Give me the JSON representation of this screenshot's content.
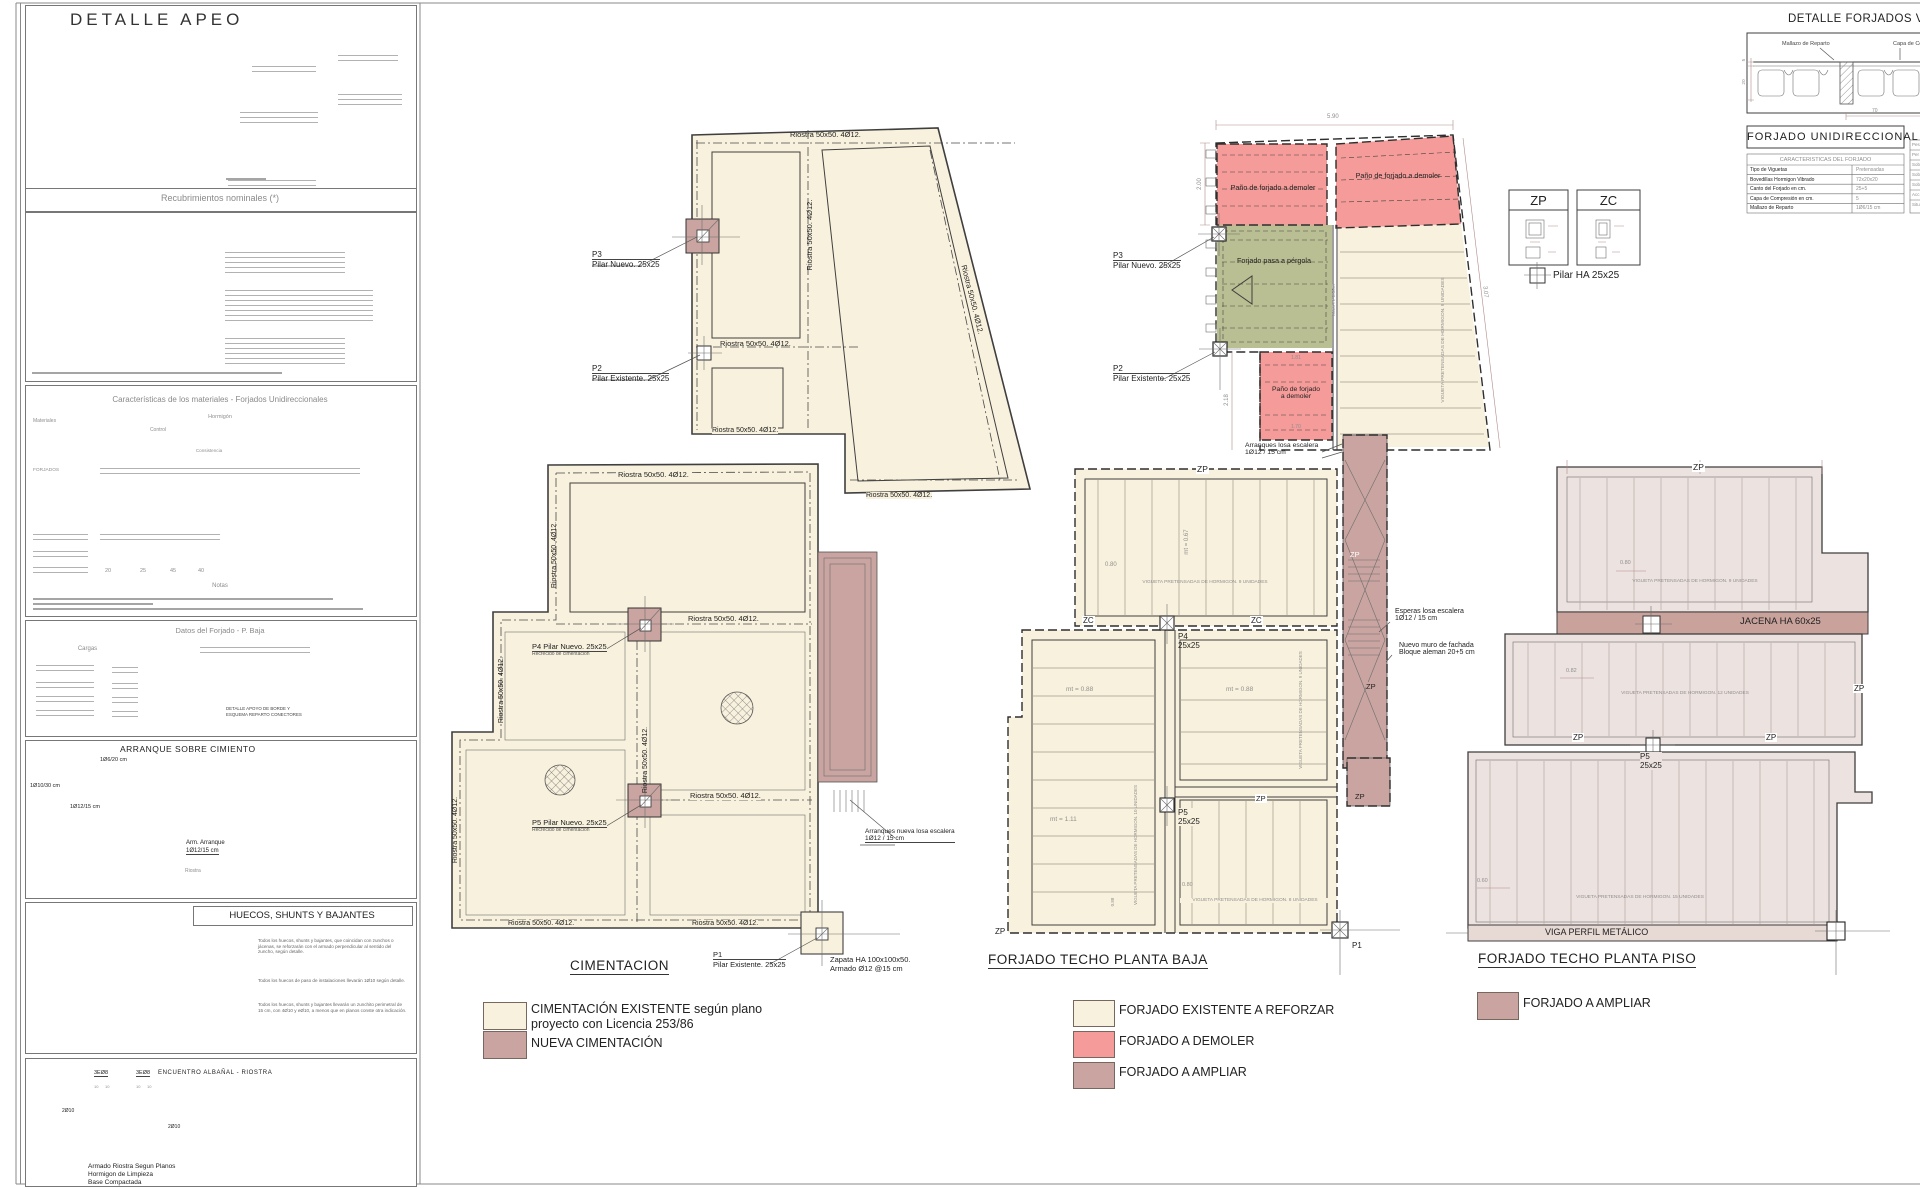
{
  "left": {
    "apeo_title": "DETALLE APEO",
    "recubrimientos_title": "Recubrimientos nominales (*)",
    "mat_title": "Características de los materiales - Forjados Unidireccionales",
    "mat_materiales": "Materiales",
    "mat_hormigon": "Hormigón",
    "mat_control": "Control",
    "mat_consistencia": "Consistencia",
    "mat_forjados": "FORJADOS",
    "mat_notas": "Notas",
    "mat_recub_vals": [
      "20",
      "25",
      "45",
      "40"
    ],
    "datos_title": "Datos del Forjado - P. Baja",
    "datos_cargas": "Cargas",
    "datos_caption1": "DETALLE APOYO DE BORDE Y",
    "datos_caption2": "ESQUEMA REPARTO CONECTORES",
    "arranque_title": "ARRANQUE SOBRE CIMIENTO",
    "arr_l1": "1Ø6/20 cm",
    "arr_l2": "1Ø10/30 cm",
    "arr_l3": "1Ø12/15 cm",
    "arr_l4": "Arm. Arranque",
    "arr_l5": "1Ø12/15 cm",
    "arr_riostra": "Riostra",
    "arr_d20": "20",
    "arr_d40": "40",
    "huecos_title": "HUECOS, SHUNTS Y BAJANTES",
    "huecos_notes": [
      "Todos los huecos, shunts y bajantes, que coincidan con zunchos o jácenas, se reforzarán con el armado perpendicular al sentido del zuncho, según detalle.",
      "Todos los huecos de paso de instalaciones llevarán 1Ø10 según detalle.",
      "Todos los huecos, shunts y bajantes llevarán un zunchito perimetral de 15 cm, con 4Ø10 y eØ10, a menos que en planos conste otra indicación."
    ],
    "enc_title": "ENCUENTRO  ALBAÑAL - RIOSTRA",
    "enc_3e8": "3EØ8",
    "enc_2o10": "2Ø10",
    "enc_10": "10",
    "enc_c1": "Armado Riostra Segun Planos",
    "enc_c2": "Hormigon de Limpieza",
    "enc_c3": "Base Compactada"
  },
  "cim": {
    "title": "CIMENTACION",
    "riostra": "Riostra 50x50. 4Ø12.",
    "p1a": "P1",
    "p1b": "Pilar Existente. 25x25",
    "p2a": "P2",
    "p2b": "Pilar Existente. 25x25",
    "p3a": "P3",
    "p3b": "Pilar Nuevo. 25x25",
    "p4": "P4 Pilar Nuevo. 25x25",
    "p5": "P5 Pilar Nuevo. 25x25",
    "recrecido": "Recrecido de cimentación",
    "zapata1": "Zapata HA 100x100x50.",
    "zapata2": "Armado Ø12 @15 cm",
    "arrq1": "Arranques nueva losa escalera",
    "arrq2": "1Ø12 / 15 cm",
    "leg1a": "CIMENTACIÓN EXISTENTE según plano",
    "leg1b": "proyecto con Licencia 253/86",
    "leg2": "NUEVA CIMENTACIÓN"
  },
  "baja": {
    "title": "FORJADO TECHO PLANTA BAJA",
    "dim_590": "5.90",
    "dim_307": "3.07",
    "dim_200": "2.00",
    "dim_218": "2.18",
    "dim_181": "1.81",
    "dim_170": "1.70",
    "demoler": "Paño de forjado a demoler",
    "demoler_a": "Paño de forjado",
    "demoler_b": "a demoler",
    "pergola": "Forjado pasa a pérgola",
    "muro": "Muro H: 1.80m",
    "p3a": "P3",
    "p3b": "Pilar Nuevo. 25x25",
    "p2a": "P2",
    "p2b": "Pilar Existente. 25x25",
    "p4a": "P4",
    "p4b": "25x25",
    "p5a": "P5",
    "p5b": "25x25",
    "p1": "P1",
    "zp": "ZP",
    "zc": "ZC",
    "mt067": "mt = 0.67",
    "mt088": "mt = 0.88",
    "mt111": "mt = 1.11",
    "d080": "0.80",
    "d088": "0.88",
    "vig9": "VIGUETA PRETENSADAS DE HORMIGON. 9 UNIDADES",
    "vig8": "VIGUETA PRETENSADAS DE HORMIGON. 8 UNIDADES",
    "vig10": "VIGUETA PRETENSADAS DE HORMIGON. 10 UNIDADES",
    "arr1": "Arranques losa escalera",
    "arr2": "1Ø12 / 15 cm",
    "esp1": "Esperas losa escalera",
    "esp2": "1Ø12 / 15 cm",
    "muro2a": "Nuevo muro de fachada",
    "muro2b": "Bloque aleman 20+5 cm",
    "leg1": "FORJADO EXISTENTE A REFORZAR",
    "leg2": "FORJADO A DEMOLER",
    "leg3": "FORJADO A AMPLIAR"
  },
  "piso": {
    "title": "FORJADO TECHO PLANTA PISO",
    "zp": "ZP",
    "jacena": "JACENA HA 60x25",
    "viga": "VIGA PERFIL METÁLICO",
    "p5a": "P5",
    "p5b": "25x25",
    "vig9": "VIGUETA PRETENSADAS DE HORMIGON. 9 UNIDADES",
    "vig12": "VIGUETA PRETENSADAS DE HORMIGON. 12 UNIDADES",
    "vig15": "VIGUETA PRETENSADAS DE HORMIGON. 15 UNIDADES",
    "d080": "0.80",
    "d082": "0.82",
    "d060": "0.60",
    "leg": "FORJADO A AMPLIAR"
  },
  "zpzc": {
    "zp": "ZP",
    "zc": "ZC",
    "pilar": "Pilar HA 25x25"
  },
  "det": {
    "title": "DETALLE FORJADOS VIGUETAS",
    "mallazo": "Mallazo de Reparto",
    "capa": "Capa de Compresión",
    "uni": "FORJADO UNIDIRECCIONAL",
    "tbl_title": "CARACTERISTICAS DEL FORJADO",
    "rows": [
      {
        "l": "Tipo de Viguetas",
        "v": "Pretensadas"
      },
      {
        "l": "Bovedillas   Hormigon Vibrado",
        "v": "72x20x20"
      },
      {
        "l": "Canto del Forjado en cm.",
        "v": "25+5"
      },
      {
        "l": "Capa de Compresión en cm.",
        "v": "5"
      },
      {
        "l": "Mallazo de Reparto",
        "v": "1Ø6/15 cm"
      }
    ],
    "dim5": "5",
    "dim20": "20",
    "dim70": "70",
    "frag": [
      "Pes",
      "Per",
      "Sob",
      "Sob",
      "Sob",
      "Acc",
      "Situ"
    ]
  },
  "colors": {
    "cream": "#f8f1dd",
    "red": "#f59b99",
    "mauve": "#c9a4a0",
    "green": "#b9bf92",
    "pink": "#ece2df"
  }
}
